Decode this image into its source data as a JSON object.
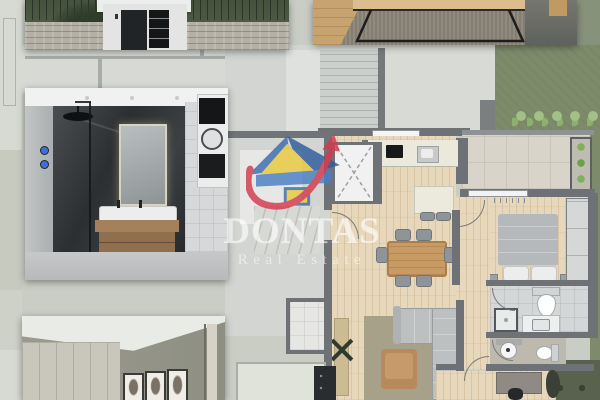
{
  "watermark": {
    "brand": "DONTAS",
    "tagline": "Real Estate"
  },
  "colors": {
    "logo_blue": "#3a6cb0",
    "logo_light_blue": "#4a7fc4",
    "logo_yellow": "#e9c93c",
    "logo_red": "#d4394e",
    "watermark_text": "#ffffff",
    "plan_background": "#c9cdc4",
    "plan_wall": "#6e7276",
    "parquet_floor": "#e7d7bb",
    "lawn_green": "#7d8b6b",
    "hedge_green": "#9dbd7d",
    "balcony_tile": "#d8d4c9",
    "bathroom_tile": "#d4d7d7",
    "rug_olive": "#a7a189",
    "sofa_gray": "#bcc0c1",
    "dining_wood": "#c89a64"
  },
  "regions": {
    "insets": [
      {
        "name": "entrance-exterior-render"
      },
      {
        "name": "coffee-table-interior-render"
      },
      {
        "name": "bathroom-interior-render"
      },
      {
        "name": "bedroom-interior-render"
      }
    ],
    "floor_plan_rooms": [
      {
        "name": "staircase"
      },
      {
        "name": "elevator"
      },
      {
        "name": "kitchen"
      },
      {
        "name": "dining-area"
      },
      {
        "name": "living-area"
      },
      {
        "name": "hallway"
      },
      {
        "name": "bedroom-1"
      },
      {
        "name": "bathroom"
      },
      {
        "name": "wc"
      },
      {
        "name": "bedroom-2"
      },
      {
        "name": "balcony"
      },
      {
        "name": "garden"
      }
    ]
  }
}
